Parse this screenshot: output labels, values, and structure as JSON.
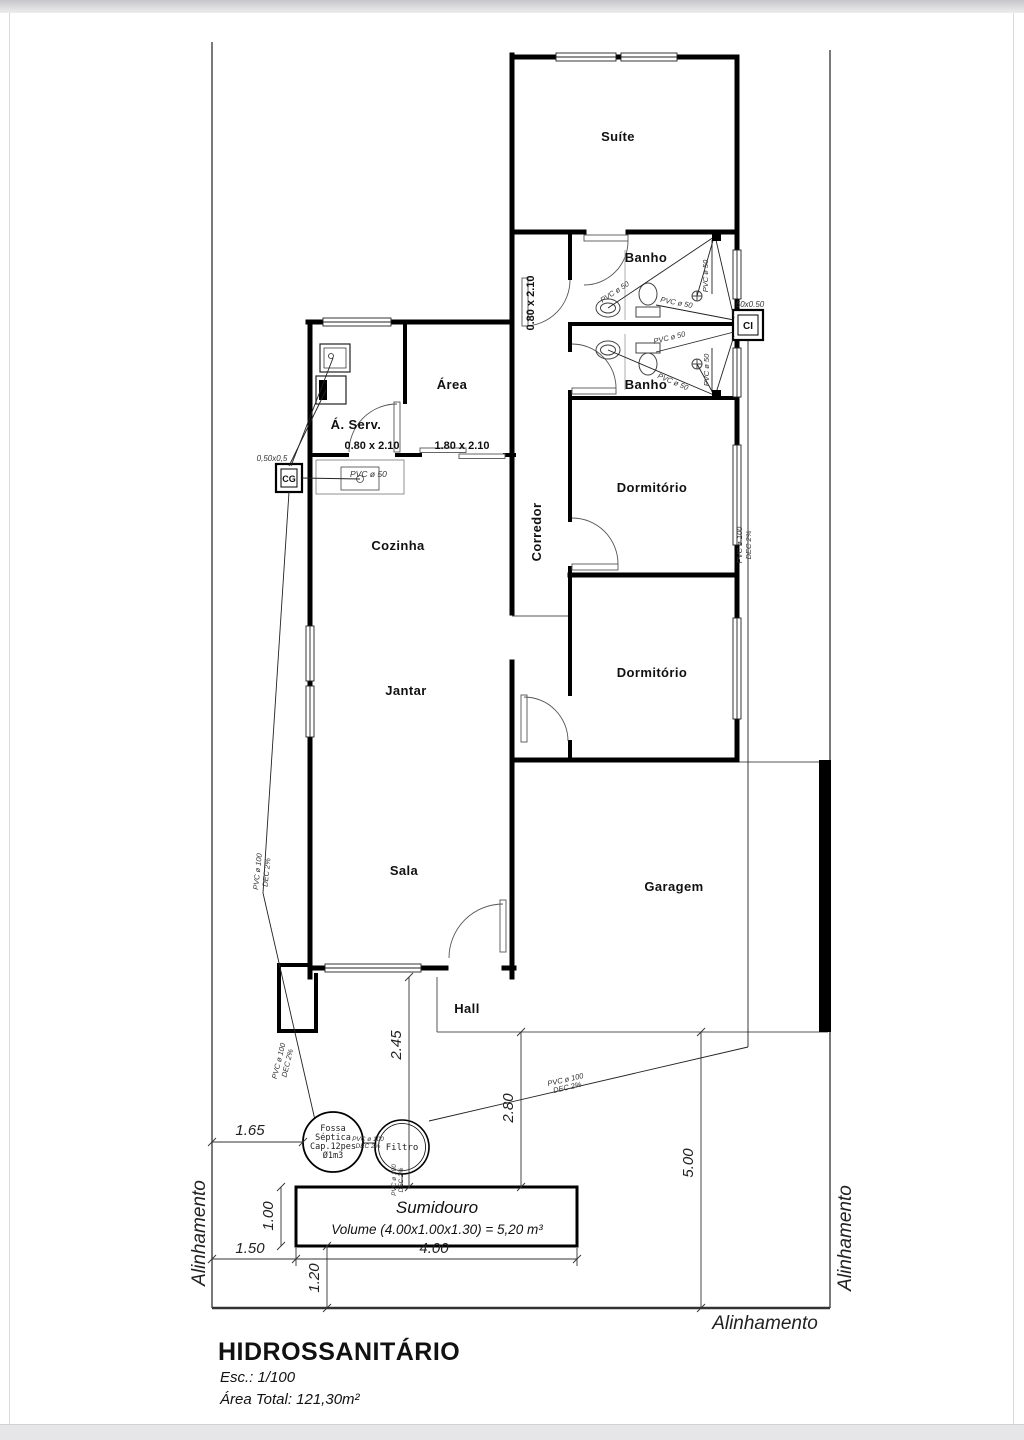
{
  "rooms": {
    "suite": "Suíte",
    "banho_suite": "Banho",
    "banho_social": "Banho",
    "area": "Área",
    "servico": "Á. Serv.",
    "corredor": "Corredor",
    "dorm1": "Dormitório",
    "dorm2": "Dormitório",
    "cozinha": "Cozinha",
    "jantar": "Jantar",
    "sala": "Sala",
    "garagem": "Garagem",
    "hall": "Hall"
  },
  "boxes": {
    "cg": "CG",
    "cg_size": "0,50x0,5",
    "ci": "CI",
    "ci_size": "50x0.50"
  },
  "openings": {
    "door_servico": "0.80 x 2.10",
    "door_area": "1.80 x 2.10",
    "door_corredor": "0.80 x 2.10"
  },
  "pipes": {
    "pvc50": "PVC ø 50",
    "pvc100": "PVC ø 100",
    "slope": "DEC 2%"
  },
  "septic": {
    "fossa1": "Fossa",
    "fossa2": "Séptica",
    "fossa3": "Cap.12pes",
    "fossa4": "Ø1m3",
    "filtro": "Filtro",
    "sumidouro": "Sumidouro",
    "volume": "Volume (4.00x1.00x1.30) = 5,20 m³"
  },
  "dims": {
    "d165": "1.65",
    "d100": "1.00",
    "d150": "1.50",
    "d400": "4.00",
    "d120": "1.20",
    "d245": "2.45",
    "d280": "2.80",
    "d500": "5.00"
  },
  "boundary": {
    "left": "Alinhamento",
    "right": "Alinhamento",
    "bottom": "Alinhamento"
  },
  "titleblock": {
    "title": "HIDROSSANITÁRIO",
    "scale": "Esc.: 1/100",
    "area_total": "Área Total: 121,30m²"
  }
}
